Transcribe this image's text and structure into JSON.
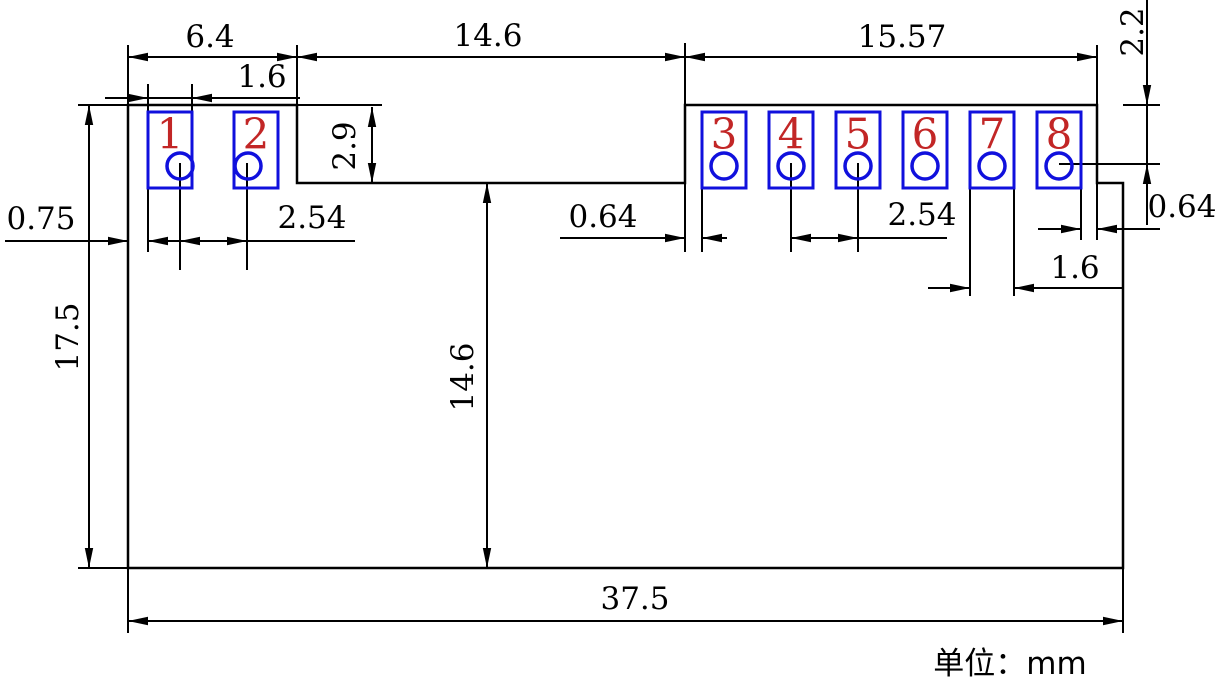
{
  "title": "module-footprint-dimension-drawing",
  "unit_label": "单位：mm",
  "colors": {
    "line": "#000000",
    "pad": "#1010dd",
    "pad_number": "#c22626",
    "background": "#ffffff"
  },
  "dimensions": {
    "top_left_section_width": "6.4",
    "notch_width": "14.6",
    "top_right_section_width": "15.57",
    "pad1_width": "1.6",
    "notch_depth": "2.9",
    "top_edge_to_hole_row": "2.2",
    "left_edge_to_pad1": "0.75",
    "left_hole_pitch": "2.54",
    "board_height": "17.5",
    "notch_to_bottom_height": "14.6",
    "edge_to_pad3": "0.64",
    "right_hole_pitch": "2.54",
    "pad7_width": "1.6",
    "pad8_to_edge": "0.64",
    "total_width": "37.5"
  },
  "pads": [
    {
      "number": "1"
    },
    {
      "number": "2"
    },
    {
      "number": "3"
    },
    {
      "number": "4"
    },
    {
      "number": "5"
    },
    {
      "number": "6"
    },
    {
      "number": "7"
    },
    {
      "number": "8"
    }
  ]
}
